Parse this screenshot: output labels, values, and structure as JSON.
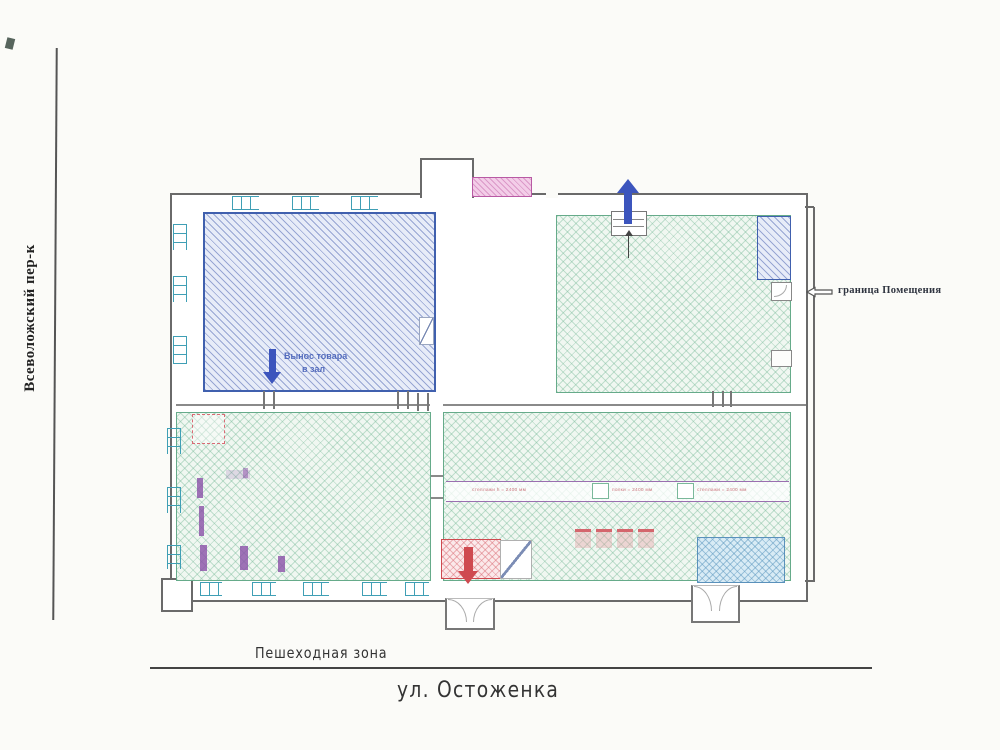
{
  "labels": {
    "street_left": "Всеволожский пер-к",
    "pedestrian_zone": "Пешеходная зона",
    "street_bottom": "ул. Остоженка",
    "boundary_note": "граница Помещения",
    "goods_exit_line1": "Вынос товара",
    "goods_exit_line2": "в зал"
  },
  "shelf_band": {
    "segments": [
      "стеллажи h = 2400 мм",
      "полки = 2400 мм",
      "стеллажи = 2400 мм"
    ]
  },
  "colors": {
    "paper": "#fbfbf8",
    "wall": "#6a6a6a",
    "blue-border": "#4060ae",
    "blue-fill": "#e7ecf8",
    "green-border": "#66ab8a",
    "green-fill": "#f0f7f1",
    "teal": "#3f9fb5",
    "pink-border": "#b85aa4",
    "pink-fill": "#f3cde8",
    "red": "#cf4a50",
    "band": "#9a6fb0",
    "arrow-blue": "#3c55bd",
    "bluebox-border": "#5a91bb",
    "bluebox-fill": "#d8ebf5",
    "purple-glyph": "#8a50a8",
    "text": "#333333"
  }
}
